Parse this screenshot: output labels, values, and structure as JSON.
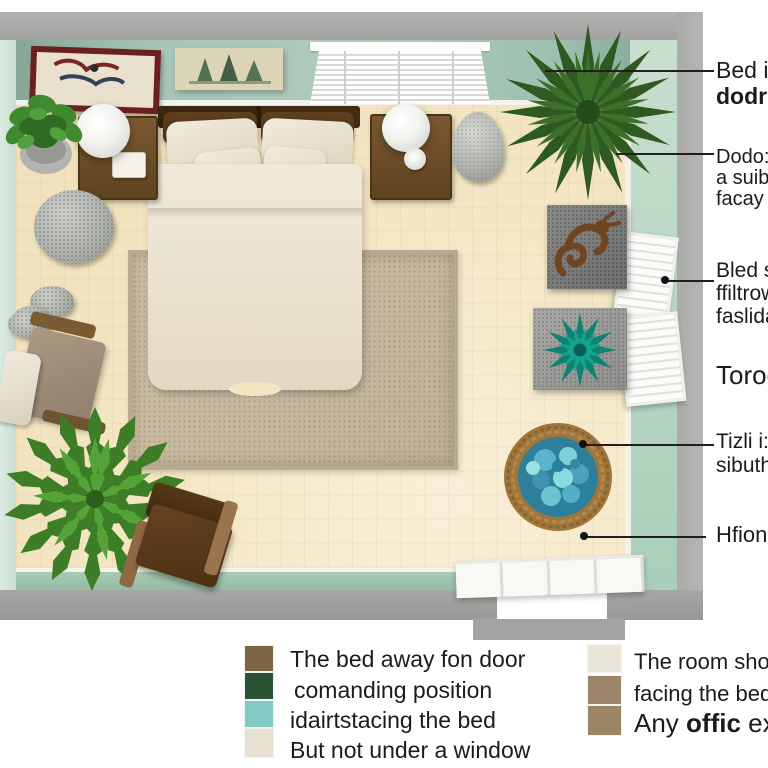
{
  "callouts": [
    {
      "lines": [
        "Bed in",
        "dodro"
      ]
    },
    {
      "lines": [
        "Dodo:",
        "a suib",
        "facay"
      ]
    },
    {
      "lines": [
        "Bled s",
        "ffiltrow",
        "faslida"
      ]
    },
    {
      "lines": [
        "Torodo"
      ]
    },
    {
      "lines": [
        "Tizli i:",
        "sibuth"
      ]
    },
    {
      "lines": [
        "Hfiono"
      ]
    }
  ],
  "legend_left": {
    "items": [
      {
        "color": "#7d6548",
        "text": "The bed away fon door"
      },
      {
        "color": "#2c5233",
        "text": "comanding position"
      },
      {
        "color": "#82cbc4",
        "text": "idairtstacing the bed"
      },
      {
        "color": "#e8e0d0",
        "text": "But not under  a  window"
      }
    ]
  },
  "legend_right": {
    "items": [
      {
        "color": "#eae5d9",
        "text": "The room should"
      },
      {
        "color": "#9c8568",
        "text": "facing the bed,"
      },
      {
        "color": "#9a8565",
        "prefix": "Any ",
        "bold": "offic",
        "suffix": " exqu"
      }
    ]
  },
  "scene": {
    "objects": [
      "bed",
      "rug",
      "nightstand-left",
      "nightstand-right",
      "lamp-left",
      "lamp-right",
      "potted-plant",
      "palm-plant",
      "fern-plant",
      "zen-stones",
      "armchair",
      "floor-chair",
      "dragon-art-tile",
      "succulent-mat",
      "pebble-basket",
      "window-blinds",
      "wall-shutters",
      "door",
      "wall-art-framed",
      "wall-art-pines"
    ],
    "colors": {
      "floor": "#f4e6c3",
      "rug": "#c6b99f",
      "wall_top": "#a7c6b7",
      "wall_left": "#d2e2d7",
      "wall_right": "#b7d5c4",
      "wall_outer": "#a7a8a6",
      "bedding": "#ece4d2",
      "wood": "#5e431f",
      "succulent": "#0e8273",
      "basket_stones": "#54b0c8"
    }
  }
}
